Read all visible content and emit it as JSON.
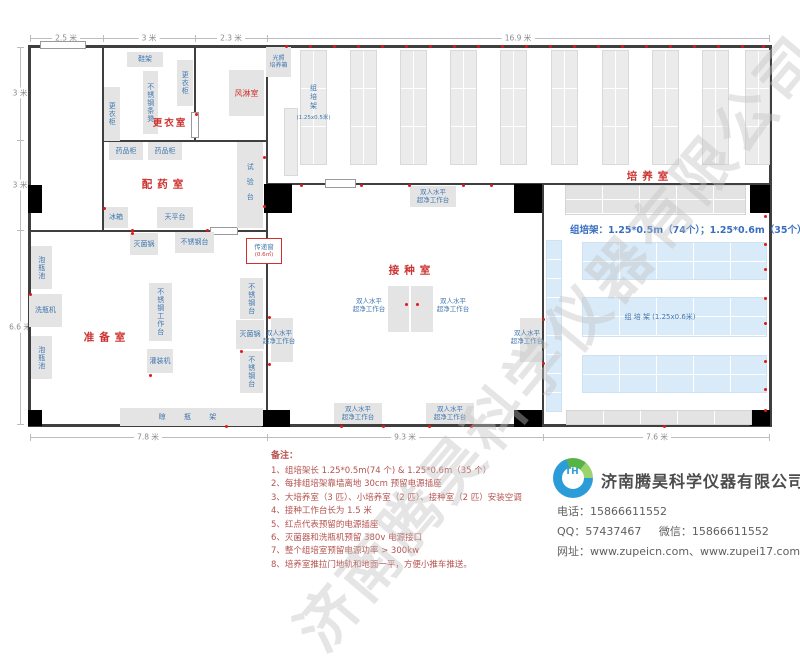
{
  "page": {
    "watermark": "济南腾昊科学仪器有限公司"
  },
  "dimensions": {
    "top": [
      "2.5 米",
      "3 米",
      "2.3 米",
      "16.9 米"
    ],
    "left": [
      "3 米",
      "3 米",
      "6.6 米"
    ],
    "bottom": [
      "7.8 米",
      "9.3 米",
      "7.6 米"
    ]
  },
  "rooms": {
    "changing_room": "更衣室",
    "air_shower": "风淋室",
    "dispensing_room": "配药室",
    "prep_room": "准备室",
    "inoculation_room": "接种室",
    "culture_room": "培养室"
  },
  "equipment": {
    "shoe_rack": "鞋架",
    "wardrobe": "更衣柜",
    "ss_bench": "不锈钢条凳",
    "medicine_cabinet": "药品柜",
    "test_bench": "试验台",
    "fridge": "冰箱",
    "balance_table": "天平台",
    "sterilizer": "灭菌锅",
    "ss_table": "不锈钢台",
    "ss_worktable": "不锈钢工作台",
    "filling_machine": "灌装机",
    "bottle_soak_pool": "泡瓶池",
    "bottle_washer": "洗瓶机",
    "bottle_drying_rack": "晾 瓶 架",
    "clean_bench": "双人水平\n超净工作台",
    "transfer_window": "传递窗",
    "transfer_window_size": "(0.6㎡)",
    "light_incubator": "光照\n培养箱",
    "culture_rack": "组培架",
    "culture_rack_small_size": "(1.25x0.5米)",
    "culture_rack_big": "组 培 架 (1.25x0.6米)",
    "rack_spec": "组培架：1.25*0.5m（74个）；1.25*0.6m（35个）"
  },
  "notes": {
    "title": "备注：",
    "items": [
      "1、组培架长 1.25*0.5m(74 个) & 1.25*0.6m（35 个）",
      "2、每排组培架靠墙离地 30cm 预留电源插座",
      "3、大培养室（3 匹）、小培养室（2 匹）、接种室（2 匹）安装空调",
      "4、接种工作台长为 1.5 米",
      "5、红点代表预留的电源插座",
      "6、灭菌器和洗瓶机预留 380v 电源接口",
      "7、整个组培室预留电源功率 > 300kw",
      "8、培养室推拉门地轨和地面一平，方便小推车推送。"
    ]
  },
  "company": {
    "name": "济南腾昊科学仪器有限公司",
    "logo_text": "TH",
    "phone_label": "电话：",
    "phone": "15866611552",
    "qq_label": "QQ：",
    "qq": "57437467",
    "wechat_label": "微信：",
    "wechat": "15866611552",
    "web_label": "网址：",
    "websites": "www.zupeicn.com、www.zupei17.com"
  }
}
